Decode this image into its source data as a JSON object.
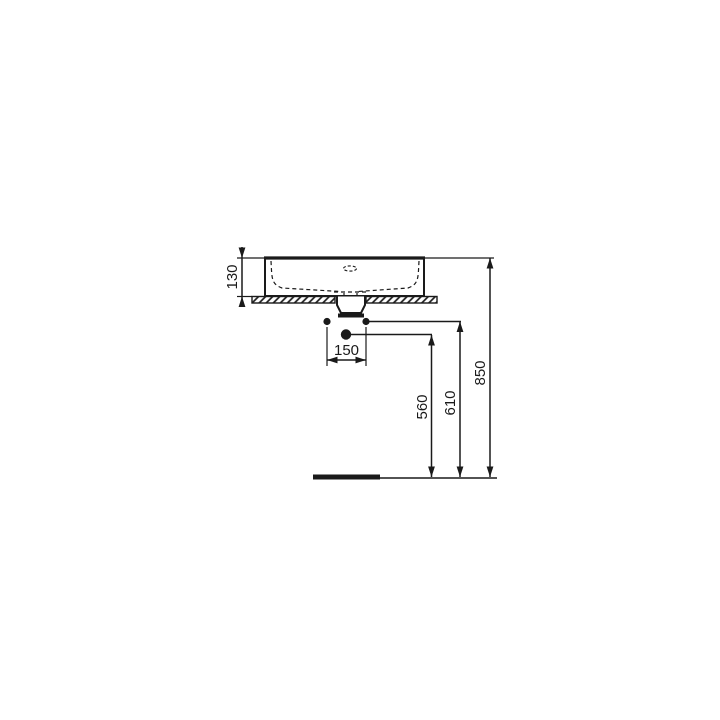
{
  "figure": {
    "kind": "technical dimension drawing",
    "subject": "countertop washbasin, front view with installation heights"
  },
  "colors": {
    "line": "#1a1a1a",
    "background": "#ffffff"
  },
  "dimensions": {
    "basin_height": "130",
    "hole_spacing": "150",
    "siphon_outlet_height": "560",
    "fixing_holes_height": "610",
    "rim_height": "850"
  }
}
